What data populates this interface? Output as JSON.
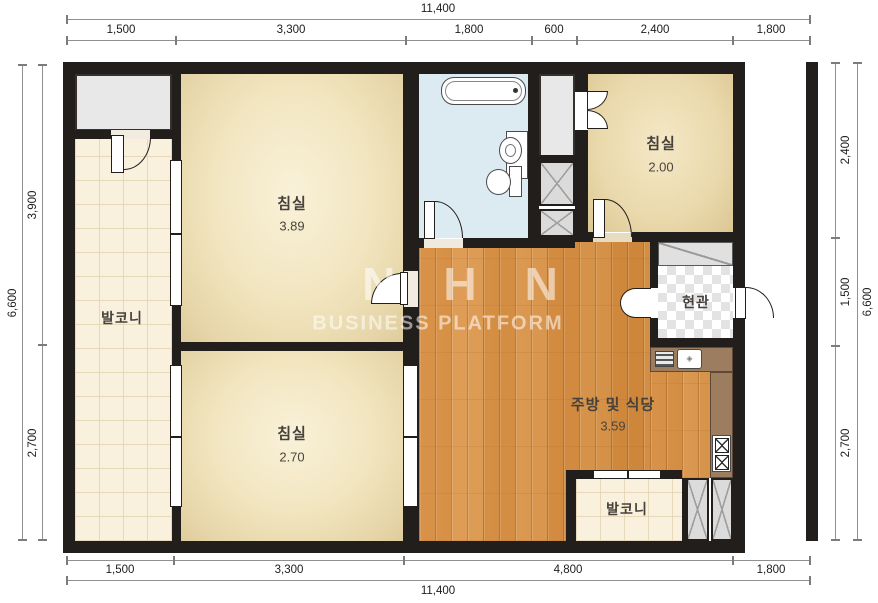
{
  "watermark": {
    "line1": "NHN",
    "line2": "BUSINESS PLATFORM"
  },
  "rooms": {
    "bedroom_large": {
      "label": "침실",
      "area": "3.89"
    },
    "bedroom_lower": {
      "label": "침실",
      "area": "2.70"
    },
    "bedroom_small": {
      "label": "침실",
      "area": "2.00"
    },
    "kitchen_dining": {
      "label": "주방 및 식당",
      "area": "3.59"
    },
    "entrance": {
      "label": "현관"
    },
    "balcony_left": {
      "label": "발코니"
    },
    "balcony_bottom": {
      "label": "발코니"
    }
  },
  "dimensions": {
    "top": {
      "total": "11,400",
      "segments": [
        "1,500",
        "3,300",
        "1,800",
        "600",
        "2,400",
        "1,800"
      ]
    },
    "bottom": {
      "total": "11,400",
      "segments": [
        "1,500",
        "3,300",
        "4,800",
        "1,800"
      ]
    },
    "left": {
      "total": "6,600",
      "segments": [
        "3,900",
        "2,700"
      ]
    },
    "right": {
      "total": "6,600",
      "segments": [
        "2,400",
        "1,500",
        "2,700"
      ]
    }
  },
  "colors": {
    "wall": "#211e1b",
    "wood_floor": "#dd9547",
    "bedroom_floor": "#f2e6c0",
    "bathroom_floor": "#dceaf2",
    "balcony_tile": "#f9f0de",
    "counter": "#9d7d5f",
    "closet_gray": "#e8e8e8"
  }
}
